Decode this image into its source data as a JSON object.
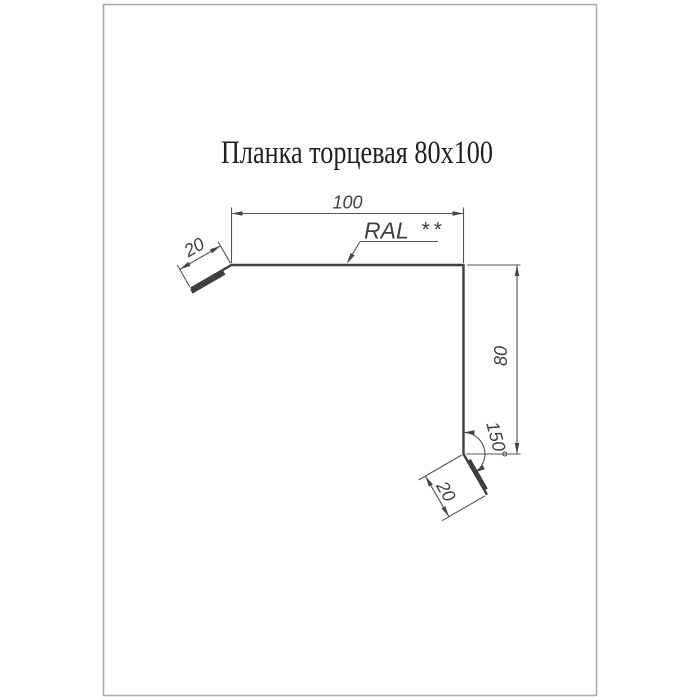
{
  "title": "Планка торцевая 80x100",
  "colors": {
    "page_bg": "#ffffff",
    "page_border": "#ababab",
    "profile": "#3f3f3f",
    "dim_line": "#555555",
    "arrow": "#444444",
    "text": "#3f3f3f",
    "title_text": "#1f1f1f"
  },
  "dimensions": {
    "top_width": "100",
    "left_flange": "20",
    "right_height": "80",
    "bottom_flange": "20",
    "bend_angle": "150°"
  },
  "labels": {
    "coating": "RAL",
    "coating_note": "**"
  },
  "product": {
    "name_ru": "Планка торцевая",
    "size": "80x100",
    "width_mm": 100,
    "height_mm": 80,
    "flange_mm": 20,
    "angle_deg": 150
  }
}
